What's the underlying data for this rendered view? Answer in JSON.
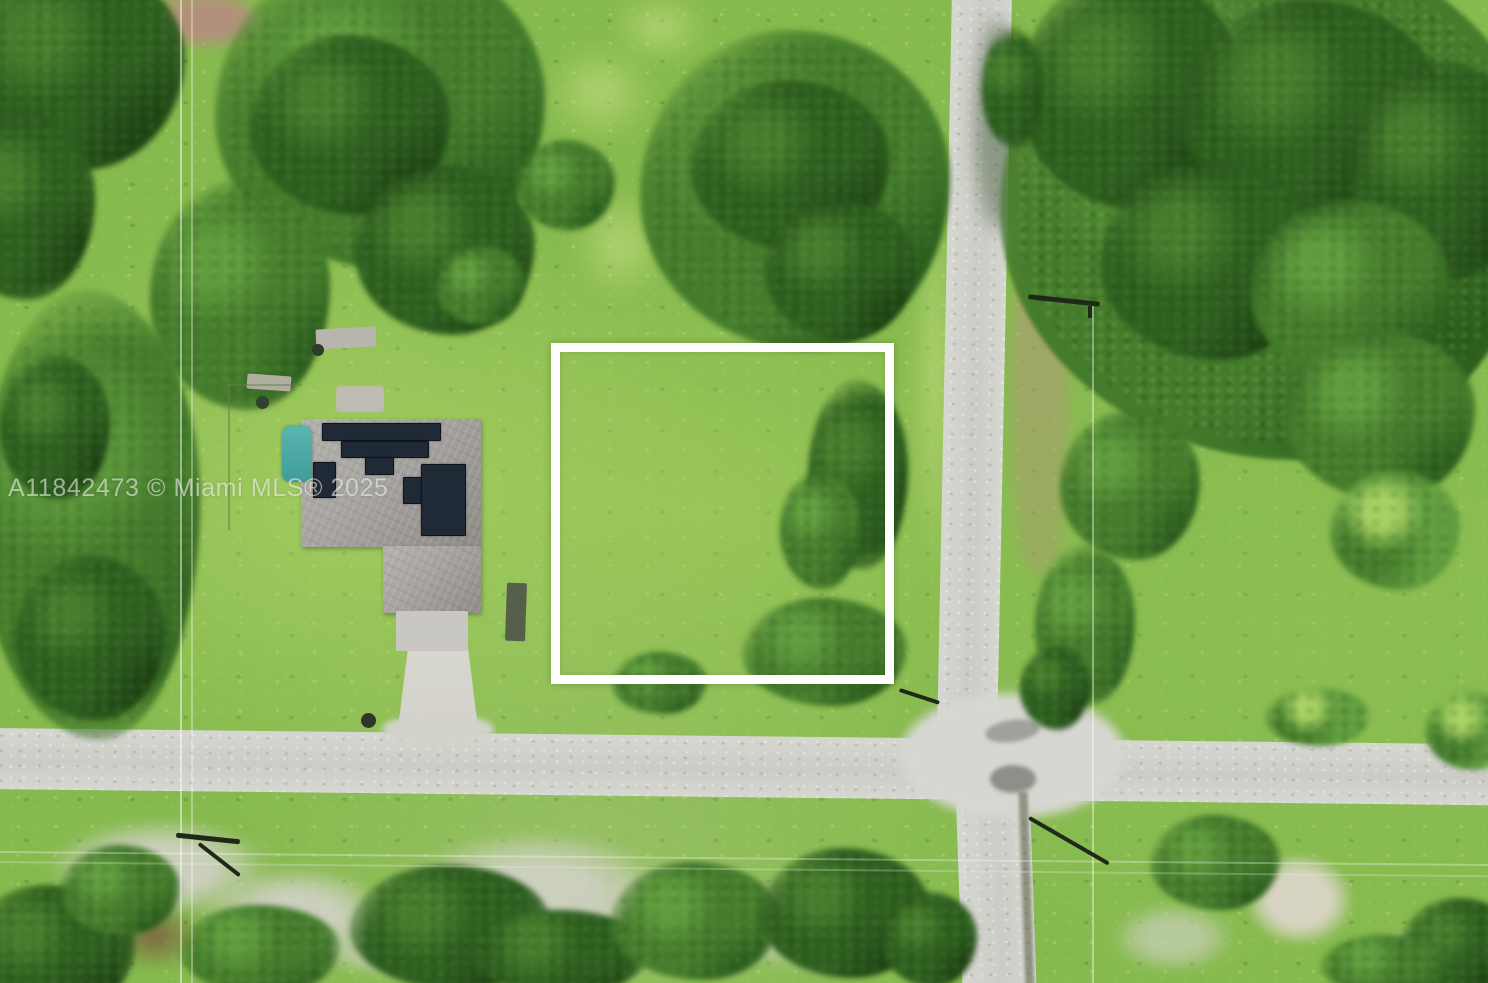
{
  "photo": {
    "kind": "aerial-drone-photograph",
    "scene": "Vacant residential lot outlined in white near a street intersection, beside a house with rooftop solar panels, surrounded by green brush, lawns and tree stands",
    "watermark": "A11842473 © Miami MLS® 2025"
  },
  "features": {
    "property_boundary": "white square outline around vacant lot",
    "house": "gray hip roof with dark solar panel arrays",
    "roads": "light gray paved cross intersection, one road running north-south, one east-west",
    "driveway": "concrete driveway from house to road",
    "utilities": "overhead power lines and utility poles"
  },
  "colors": {
    "grass_base": "#86ba4e",
    "grass_light": "#a6d162",
    "scrub_green": "#7eb347",
    "tree_darkest": "#1d4313",
    "tree_dark": "#2c5e1e",
    "tree_mid": "#447c2b",
    "tree_soft": "#5f9c3d",
    "road": "#cbccc6",
    "road_light": "#d6d7d1",
    "driveway": "#d3d2ca",
    "roof_gray": "#a6a3a0",
    "solar_dark": "#202a36",
    "pool_teal": "#3f9d99",
    "boundary_white": "#fefefe",
    "dirt_brown": "#b3907b",
    "brush_gray": "#ccd0bd",
    "sand": "#d8d4c2",
    "wire_dark": "#1f2917",
    "watermark_white": "rgba(255,255,255,0.55)"
  }
}
